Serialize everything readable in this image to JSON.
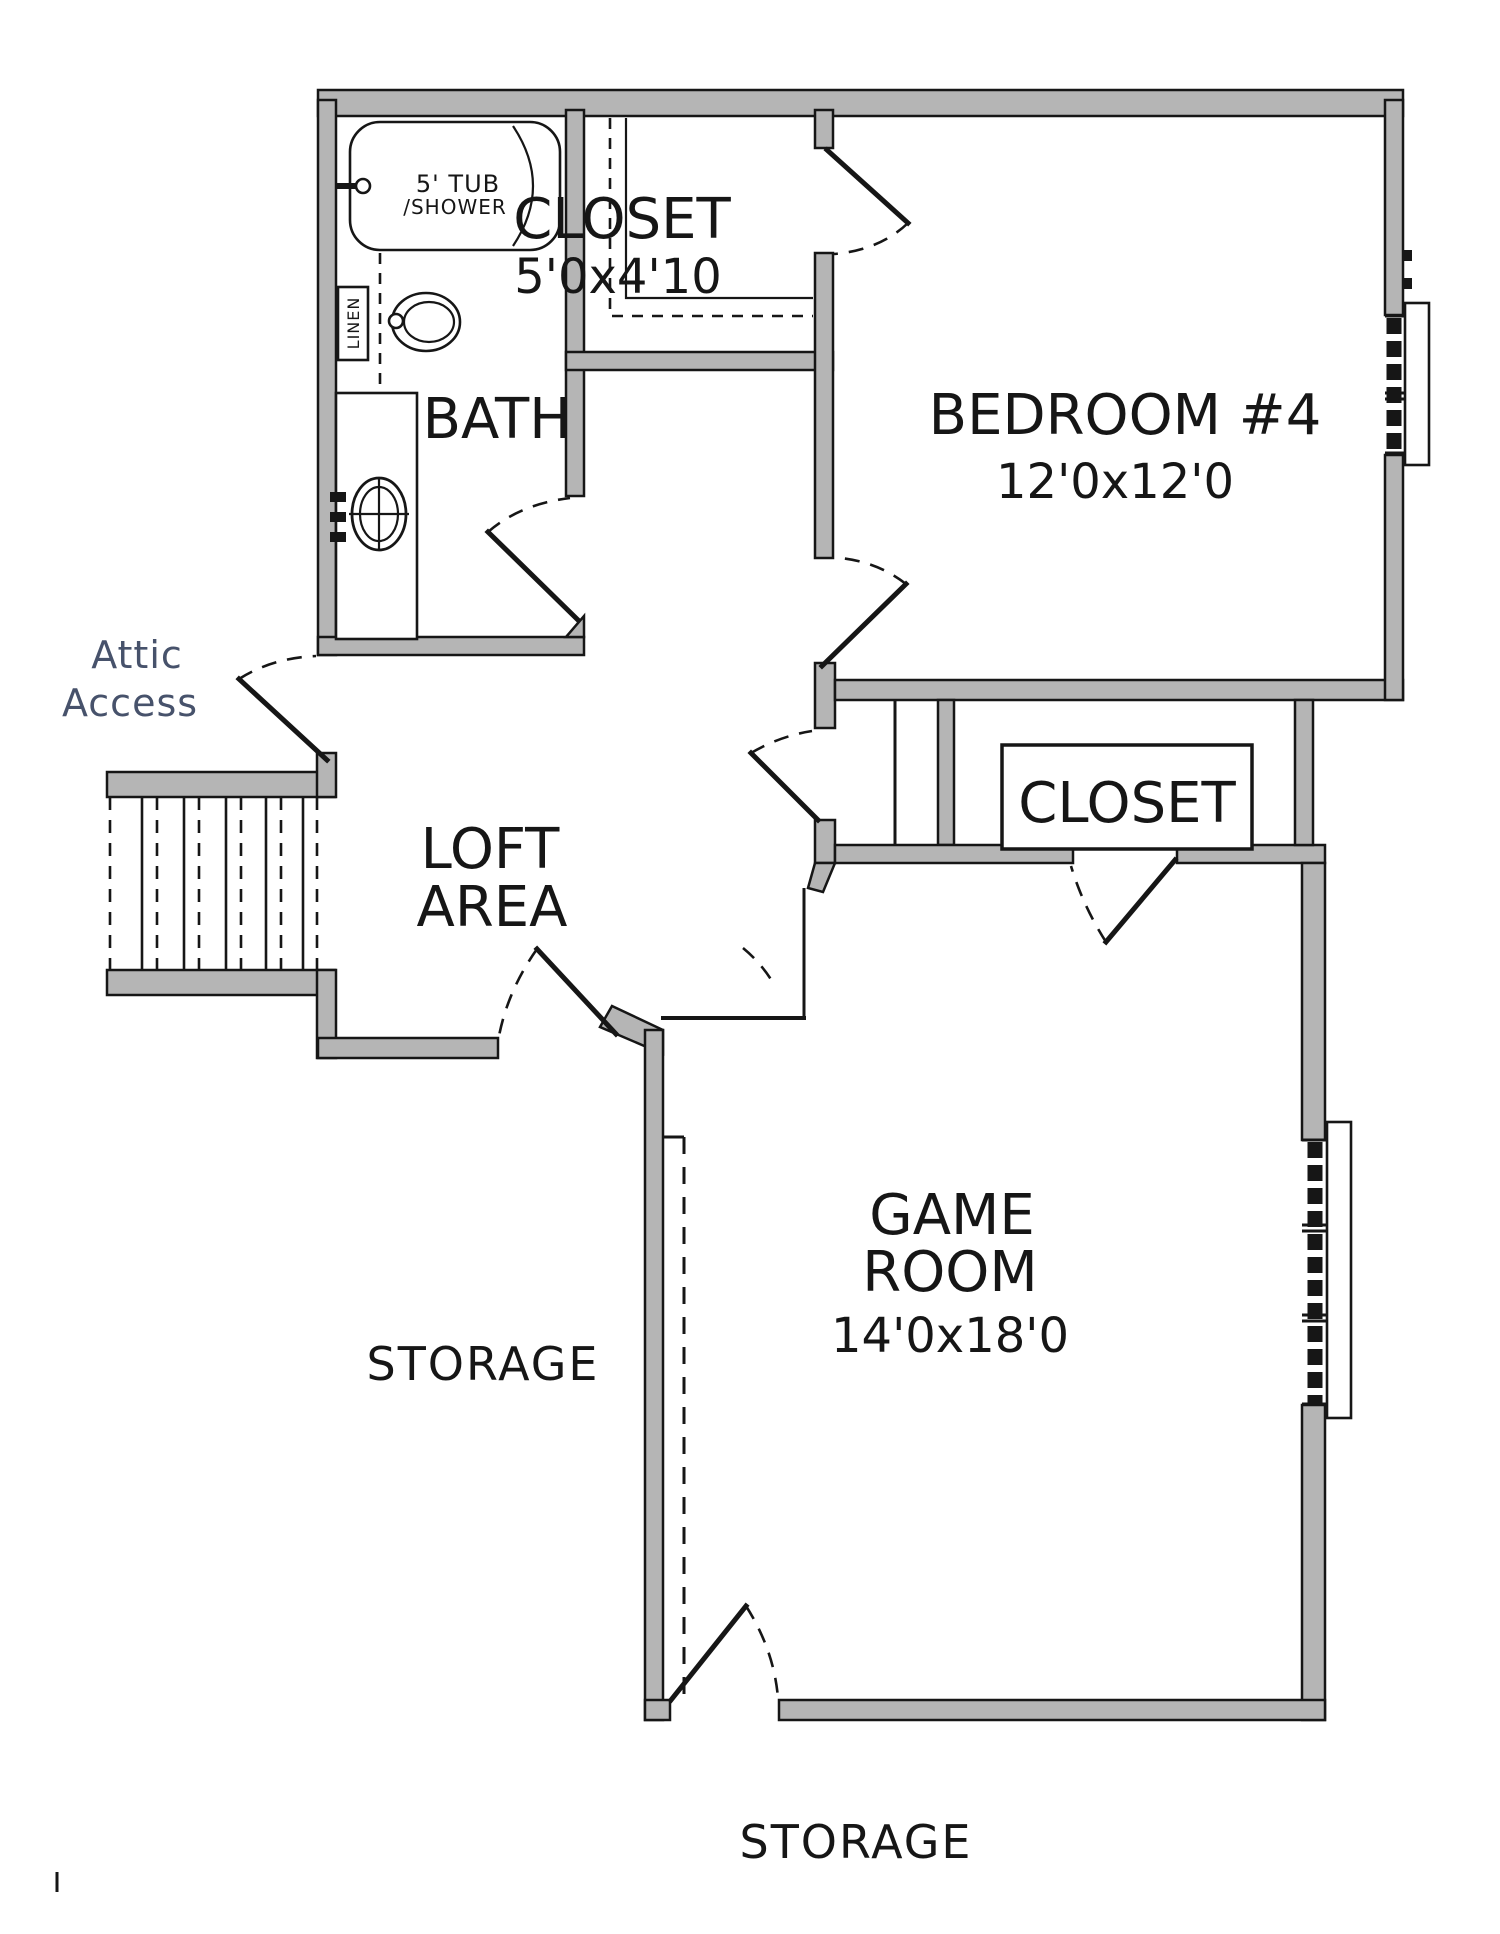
{
  "colors": {
    "wall_fill": "#b5b5b5",
    "line": "#161616",
    "annotation_text": "#47526b",
    "background": "#ffffff"
  },
  "rooms": {
    "bath": {
      "label": "BATH"
    },
    "closet_top": {
      "label": "CLOSET",
      "dims": "5'0x4'10"
    },
    "bedroom4": {
      "label": "BEDROOM #4",
      "dims": "12'0x12'0"
    },
    "loft": {
      "label_line1": "LOFT",
      "label_line2": "AREA"
    },
    "closet_game": {
      "label": "CLOSET"
    },
    "game_room": {
      "label_line1": "GAME",
      "label_line2": "ROOM",
      "dims": "14'0x18'0"
    },
    "storage_left": {
      "label": "STORAGE"
    },
    "storage_bottom": {
      "label": "STORAGE"
    }
  },
  "fixtures": {
    "tub": {
      "label_line1": "5' TUB",
      "label_line2": "/SHOWER"
    },
    "linen": {
      "label": "LINEN"
    }
  },
  "annotations": {
    "attic_access": {
      "label_line1": "Attic",
      "label_line2": "Access"
    }
  }
}
